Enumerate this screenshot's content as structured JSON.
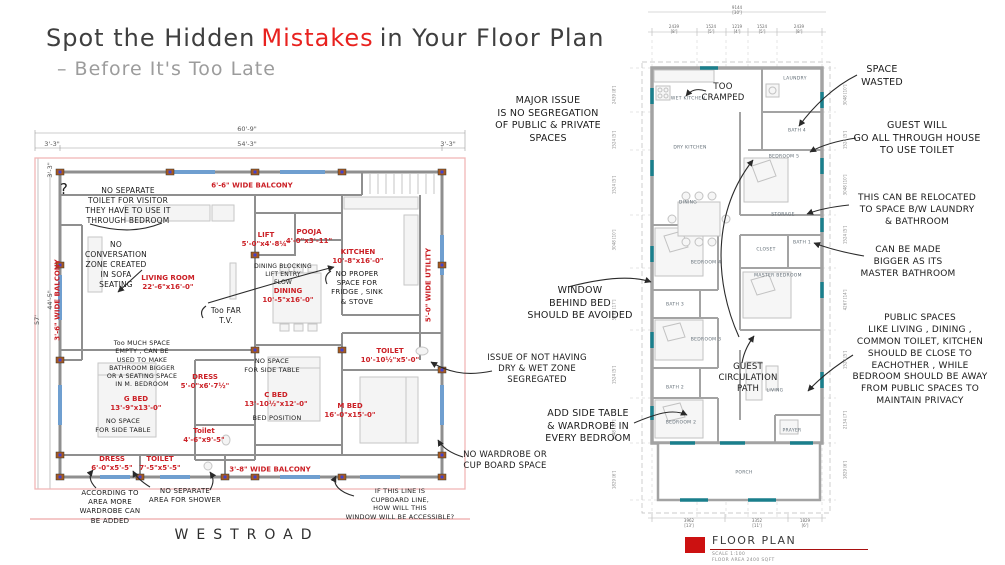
{
  "title": {
    "prefix": "Spot the Hidden",
    "highlight": "Mistakes",
    "suffix": "in Your Floor Plan",
    "subtitle": "– Before It's Too Late"
  },
  "colors": {
    "accent_red": "#e8221f",
    "room_label_red": "#cb2026",
    "wall_gray": "#8f8f8f",
    "window_blue": "#6f9fd0",
    "window_teal": "#1a7f8c",
    "boundary_pink": "#f0b6b6",
    "note_ink": "#1b1b1b",
    "legend_red": "#cc1111"
  },
  "left_plan": {
    "road_label": "WESTROAD",
    "dims": [
      {
        "text": "60'-9\"",
        "x": 247,
        "y": 129
      },
      {
        "text": "3'-3\"",
        "x": 52,
        "y": 144
      },
      {
        "text": "54'-3\"",
        "x": 247,
        "y": 144
      },
      {
        "text": "3'-3\"",
        "x": 448,
        "y": 144
      },
      {
        "text": "57'",
        "x": 37,
        "y": 320,
        "vertical": true
      },
      {
        "text": "44'-5\"",
        "x": 50,
        "y": 300,
        "vertical": true
      },
      {
        "text": "3'-3\"",
        "x": 50,
        "y": 170,
        "vertical": true
      }
    ],
    "rooms": [
      {
        "label": "6'-6\" WIDE BALCONY",
        "x": 252,
        "y": 186
      },
      {
        "label": "LIVING ROOM",
        "dim": "22'-6\"x16'-0\"",
        "x": 168,
        "y": 283
      },
      {
        "label": "LIFT",
        "dim": "5'-0\"x4'-8¼\"",
        "x": 266,
        "y": 240
      },
      {
        "label": "POOJA",
        "dim": "4'-0\"x3'-11\"",
        "x": 309,
        "y": 237
      },
      {
        "label": "KITCHEN",
        "dim": "10'-8\"x16'-0\"",
        "x": 358,
        "y": 257
      },
      {
        "label": "DINING",
        "dim": "10'-5\"x16'-0\"",
        "x": 288,
        "y": 296
      },
      {
        "label": "5'-0\" WIDE UTILITY",
        "x": 429,
        "y": 285,
        "vertical": true
      },
      {
        "label": "3'-6\" WIDE BALCONY",
        "x": 58,
        "y": 300,
        "vertical": true
      },
      {
        "label": "DRESS",
        "dim": "5'-0\"x6'-7½\"",
        "x": 205,
        "y": 382
      },
      {
        "label": "G BED",
        "dim": "13'-9\"x13'-0\"",
        "x": 136,
        "y": 404
      },
      {
        "label": "C BED",
        "dim": "13'-10½\"x12'-0\"",
        "x": 276,
        "y": 400
      },
      {
        "label": "M BED",
        "dim": "16'-0\"x15'-0\"",
        "x": 350,
        "y": 411
      },
      {
        "label": "TOILET",
        "dim": "10'-10½\"x5'-0\"",
        "x": 390,
        "y": 356
      },
      {
        "label": "Toilet",
        "dim": "4'-6\"x9'-5\"",
        "x": 204,
        "y": 436
      },
      {
        "label": "DRESS",
        "dim": "6'-0\"x5'-5\"",
        "x": 112,
        "y": 464
      },
      {
        "label": "TOILET",
        "dim": "7'-5\"x5'-5\"",
        "x": 160,
        "y": 464
      },
      {
        "label": "3'-8\" WIDE BALCONY",
        "x": 270,
        "y": 470
      }
    ]
  },
  "right_plan": {
    "rooms": [
      {
        "label": "WET KITCHEN",
        "x": 688,
        "y": 99
      },
      {
        "label": "LAUNDRY",
        "x": 795,
        "y": 79
      },
      {
        "label": "BATH 4",
        "x": 797,
        "y": 131
      },
      {
        "label": "BEDROOM 5",
        "x": 784,
        "y": 157
      },
      {
        "label": "DRY KITCHEN",
        "x": 690,
        "y": 148
      },
      {
        "label": "DINING",
        "x": 688,
        "y": 203
      },
      {
        "label": "STORAGE",
        "x": 783,
        "y": 215
      },
      {
        "label": "CLOSET",
        "x": 766,
        "y": 250
      },
      {
        "label": "BATH 1",
        "x": 802,
        "y": 243
      },
      {
        "label": "MASTER BEDROOM",
        "x": 778,
        "y": 276
      },
      {
        "label": "BEDROOM 4",
        "x": 706,
        "y": 263
      },
      {
        "label": "BATH 3",
        "x": 675,
        "y": 305
      },
      {
        "label": "BEDROOM 3",
        "x": 706,
        "y": 340
      },
      {
        "label": "BATH 2",
        "x": 675,
        "y": 388
      },
      {
        "label": "BEDROOM 2",
        "x": 681,
        "y": 423
      },
      {
        "label": "LIVING",
        "x": 775,
        "y": 391
      },
      {
        "label": "PRAYER",
        "x": 792,
        "y": 431
      },
      {
        "label": "PORCH",
        "x": 744,
        "y": 473
      }
    ],
    "dims_top_overall": {
      "mm": "9144",
      "ft": "[30']",
      "x": 737,
      "y": 11
    },
    "dims_top_segments": [
      {
        "mm": "2439",
        "ft": "[8']",
        "x": 674,
        "y": 30
      },
      {
        "mm": "1524",
        "ft": "[5']",
        "x": 711,
        "y": 30
      },
      {
        "mm": "1219",
        "ft": "[4']",
        "x": 737,
        "y": 30
      },
      {
        "mm": "1524",
        "ft": "[5']",
        "x": 762,
        "y": 30
      },
      {
        "mm": "2439",
        "ft": "[8']",
        "x": 799,
        "y": 30
      }
    ],
    "dims_bottom": [
      {
        "mm": "3962",
        "ft": "[13']",
        "x": 689,
        "y": 524
      },
      {
        "mm": "3352",
        "ft": "[11']",
        "x": 757,
        "y": 524
      },
      {
        "mm": "1829",
        "ft": "[6']",
        "x": 805,
        "y": 524
      }
    ],
    "dims_side_left": [
      {
        "text": "2439 [8']",
        "y": 95
      },
      {
        "text": "1524 [5']",
        "y": 140
      },
      {
        "text": "1524 [5']",
        "y": 185
      },
      {
        "text": "3048 [10']",
        "y": 240
      },
      {
        "text": "5182 [17']",
        "y": 310
      },
      {
        "text": "1524 [5']",
        "y": 375
      },
      {
        "text": "3048 [10']",
        "y": 430
      },
      {
        "text": "1829 [6']",
        "y": 480
      }
    ],
    "dims_side_right": [
      {
        "text": "3048 [10']",
        "y": 95
      },
      {
        "text": "1524 [5']",
        "y": 140
      },
      {
        "text": "3048 [10']",
        "y": 185
      },
      {
        "text": "1524 [5']",
        "y": 235
      },
      {
        "text": "4267 [14']",
        "y": 300
      },
      {
        "text": "1524 [5']",
        "y": 360
      },
      {
        "text": "2134 [7']",
        "y": 420
      },
      {
        "text": "1829 [6']",
        "y": 470
      }
    ],
    "legend": {
      "title": "FLOOR PLAN",
      "scale": "SCALE 1:100",
      "area": "FLOOR AREA 2400 SQFT"
    }
  },
  "notes": [
    {
      "name": "question-mark",
      "x": 64,
      "y": 180,
      "size": 15,
      "lines": [
        "?"
      ]
    },
    {
      "name": "no-separate-toilet",
      "x": 128,
      "y": 186,
      "size": 7.5,
      "lines": [
        "NO SEPARATE",
        "TOILET FOR VISITOR",
        "THEY HAVE TO USE IT",
        "THROUGH BEDROOM"
      ]
    },
    {
      "name": "no-conversation-zone",
      "x": 116,
      "y": 240,
      "size": 7.5,
      "lines": [
        "NO",
        "CONVERSATION",
        "ZONE CREATED",
        "IN SOFA",
        "SEATING"
      ]
    },
    {
      "name": "too-far-tv",
      "x": 226,
      "y": 306,
      "size": 7.5,
      "lines": [
        "Too FAR",
        "T.V."
      ]
    },
    {
      "name": "dining-blocking-lift",
      "x": 283,
      "y": 263,
      "size": 6,
      "lines": [
        "DINING BLOCKING",
        "LIFT ENTRY",
        "FLOW"
      ]
    },
    {
      "name": "no-proper-space-fridge",
      "x": 357,
      "y": 270,
      "size": 7,
      "lines": [
        "NO PROPER",
        "SPACE FOR",
        "FRIDGE , SINK",
        "& STOVE"
      ]
    },
    {
      "name": "too-much-space-empty",
      "x": 142,
      "y": 340,
      "size": 6.3,
      "lines": [
        "Too MUCH SPACE",
        "EMPTY , CAN BE",
        "USED TO MAKE",
        "BATHROOM BIGGER",
        "OR A SEATING SPACE",
        "IN M. BEDROOM"
      ]
    },
    {
      "name": "no-space-side-table-c-bed",
      "x": 272,
      "y": 357,
      "size": 6.5,
      "lines": [
        "NO SPACE",
        "FOR SIDE TABLE"
      ]
    },
    {
      "name": "bed-position",
      "x": 277,
      "y": 414,
      "size": 6.5,
      "lines": [
        "BED POSITION"
      ]
    },
    {
      "name": "no-space-side-table-g-bed",
      "x": 123,
      "y": 417,
      "size": 6.5,
      "lines": [
        "NO SPACE",
        "FOR SIDE TABLE"
      ]
    },
    {
      "name": "according-to-area",
      "x": 110,
      "y": 489,
      "size": 7,
      "lines": [
        "ACCORDING TO",
        "AREA MORE",
        "WARDROBE CAN",
        "BE ADDED"
      ]
    },
    {
      "name": "no-separate-shower",
      "x": 185,
      "y": 487,
      "size": 7,
      "lines": [
        "NO SEPARATE",
        "AREA FOR SHOWER"
      ]
    },
    {
      "name": "if-this-line-cupboard",
      "x": 400,
      "y": 487,
      "size": 6.5,
      "lines": [
        "IF THIS LINE IS",
        "CUPBOARD LINE,",
        "HOW WILL THIS",
        "WINDOW WILL BE ACCESSIBLE?"
      ]
    },
    {
      "name": "major-issue-segregation",
      "x": 548,
      "y": 95,
      "size": 9.5,
      "lines": [
        "MAJOR ISSUE",
        "IS NO SEGREGATION",
        "OF PUBLIC & PRIVATE",
        "SPACES"
      ]
    },
    {
      "name": "window-behind-bed",
      "x": 580,
      "y": 285,
      "size": 9.5,
      "lines": [
        "WINDOW",
        "BEHIND BED",
        "SHOULD BE AVOIDED"
      ]
    },
    {
      "name": "issue-dry-wet-zone",
      "x": 537,
      "y": 353,
      "size": 8.5,
      "lines": [
        "ISSUE OF NOT HAVING",
        "DRY & WET ZONE",
        "SEGREGATED"
      ]
    },
    {
      "name": "add-side-table-wardrobe",
      "x": 588,
      "y": 408,
      "size": 9.5,
      "lines": [
        "ADD SIDE TABLE",
        "& WARDROBE IN",
        "EVERY BEDROOM"
      ]
    },
    {
      "name": "no-wardrobe-cupboard",
      "x": 505,
      "y": 450,
      "size": 8.5,
      "lines": [
        "NO WARDROBE OR",
        "CUP BOARD SPACE"
      ]
    },
    {
      "name": "too-cramped",
      "x": 723,
      "y": 82,
      "size": 8.5,
      "lines": [
        "TOO",
        "CRAMPED"
      ]
    },
    {
      "name": "space-wasted",
      "x": 882,
      "y": 64,
      "size": 9.5,
      "lines": [
        "SPACE",
        "WASTED"
      ]
    },
    {
      "name": "guest-toilet-path",
      "x": 917,
      "y": 120,
      "size": 9.5,
      "lines": [
        "GUEST WILL",
        "GO ALL THROUGH HOUSE",
        "TO USE TOILET"
      ]
    },
    {
      "name": "relocate-laundry-bathroom",
      "x": 917,
      "y": 193,
      "size": 9,
      "lines": [
        "THIS CAN BE RELOCATED",
        "TO SPACE B/W LAUNDRY",
        "& BATHROOM"
      ]
    },
    {
      "name": "master-bathroom-bigger",
      "x": 908,
      "y": 245,
      "size": 9,
      "lines": [
        "CAN BE MADE",
        "BIGGER AS ITS",
        "MASTER BATHROOM"
      ]
    },
    {
      "name": "public-spaces-privacy",
      "x": 920,
      "y": 313,
      "size": 9,
      "lines": [
        "PUBLIC SPACES",
        "LIKE LIVING , DINING ,",
        "COMMON TOILET,  KITCHEN",
        "SHOULD BE CLOSE TO",
        "EACHOTHER ,  WHILE",
        "BEDROOM SHOULD BE AWAY",
        "FROM PUBLIC SPACES TO",
        "MAINTAIN PRIVACY"
      ]
    },
    {
      "name": "guest-circulation-path",
      "x": 748,
      "y": 362,
      "size": 8.5,
      "lines": [
        "GUEST",
        "CIRCULATION",
        "PATH"
      ]
    }
  ]
}
